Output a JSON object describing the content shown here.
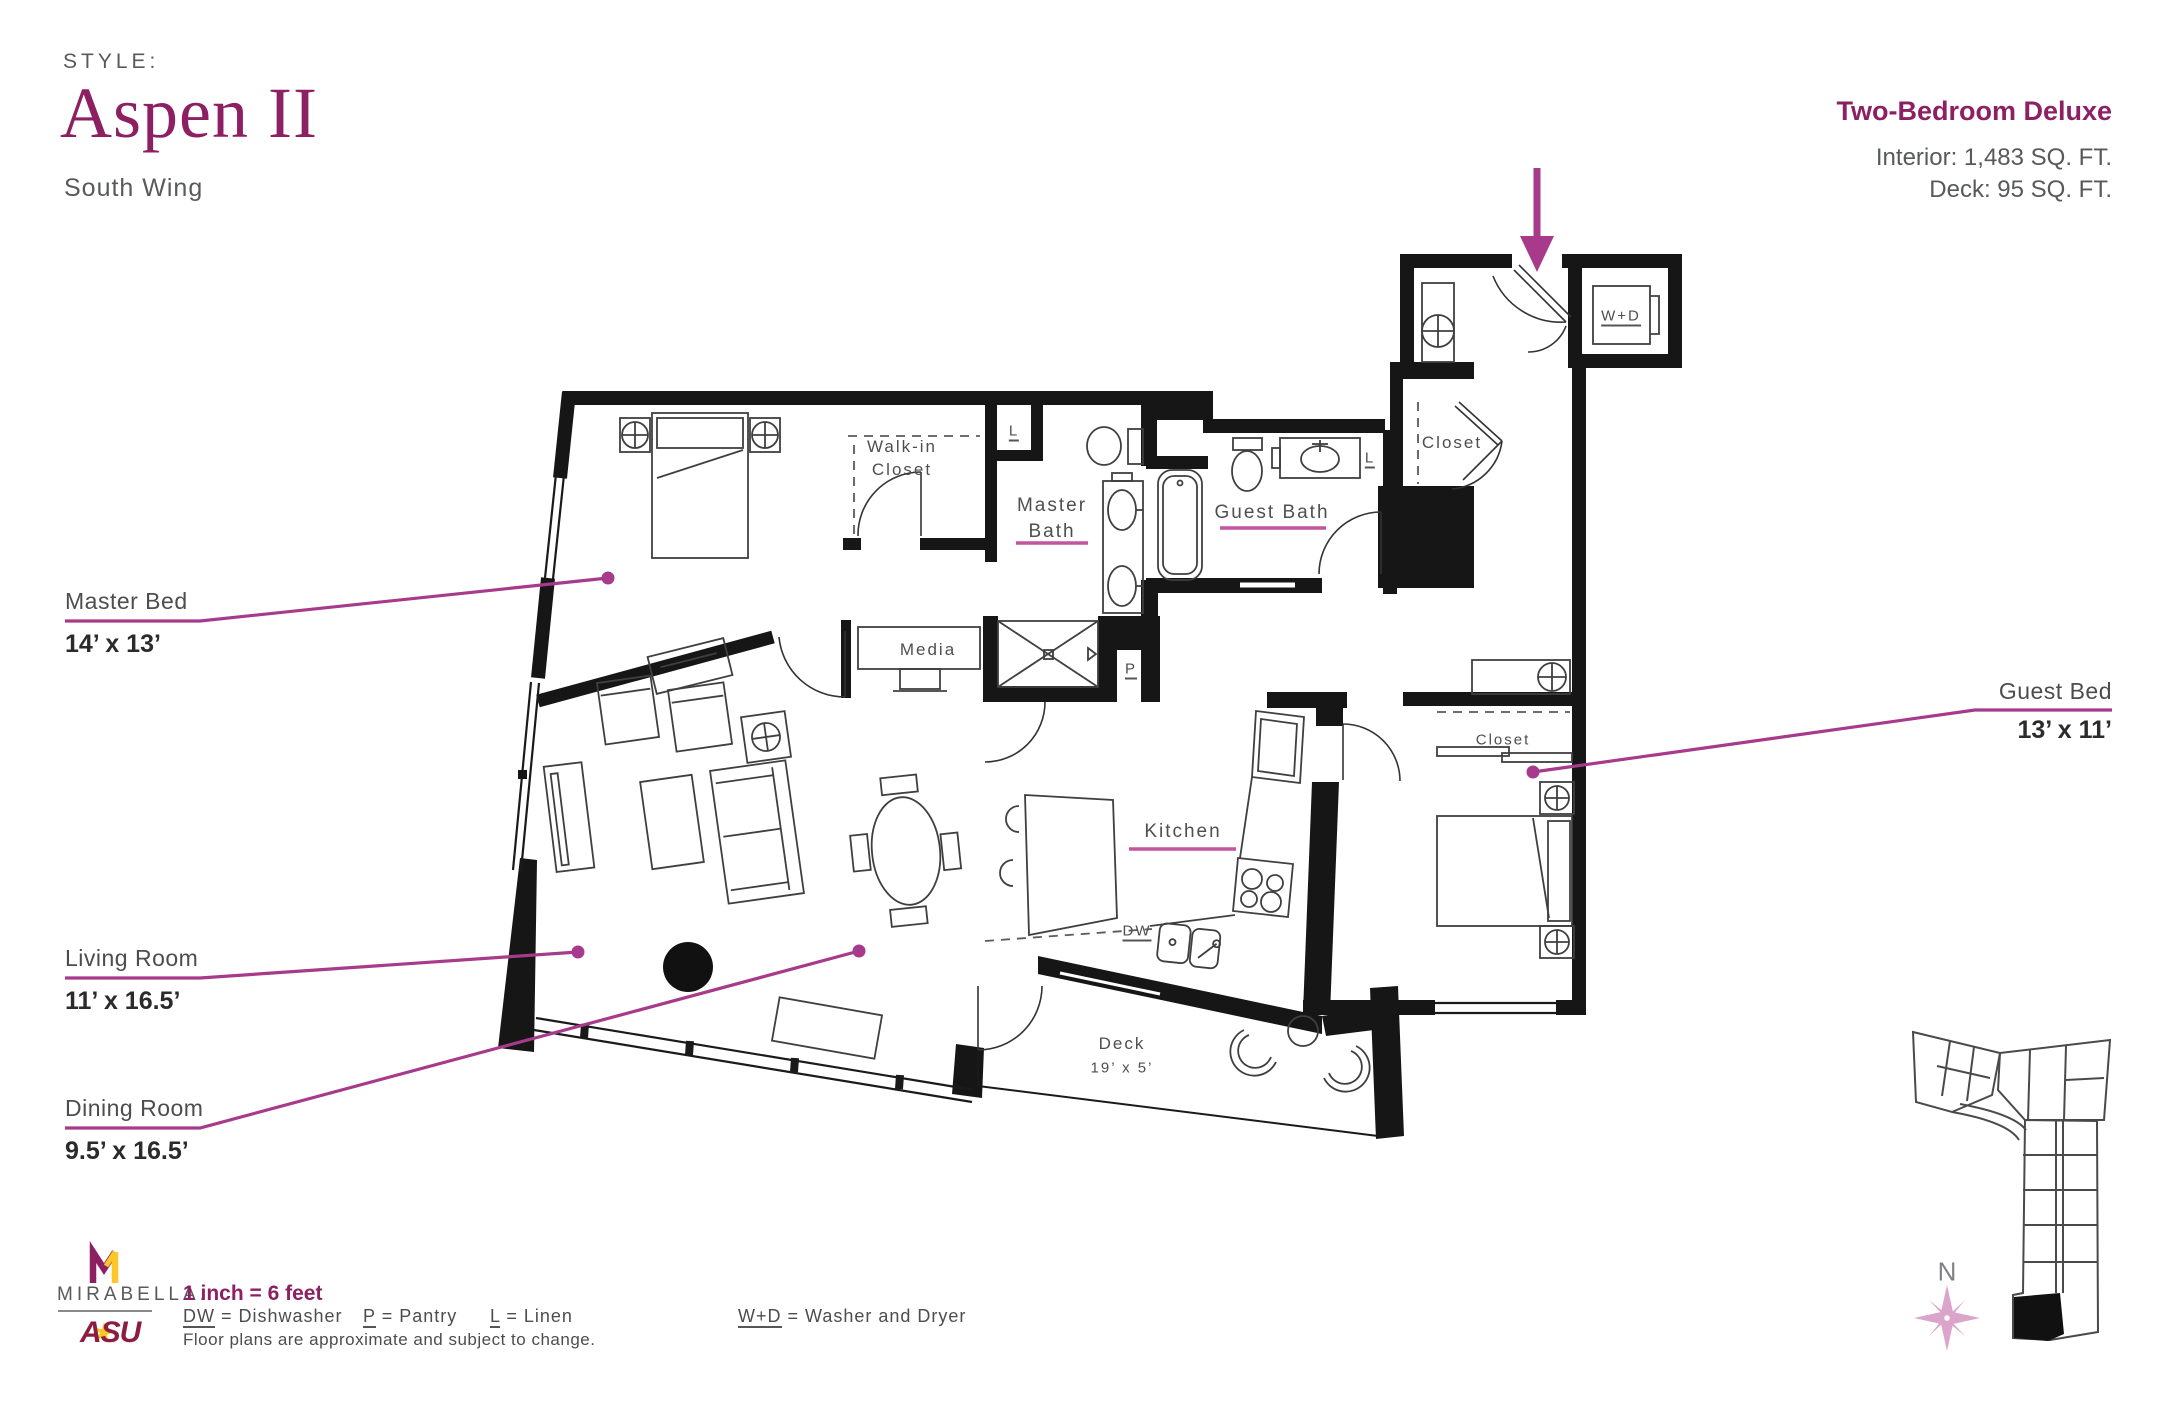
{
  "header": {
    "style_label": "STYLE:",
    "style_name": "Aspen II",
    "wing": "South Wing",
    "plan_type": "Two-Bedroom Deluxe",
    "interior_sqft": "Interior: 1,483 SQ. FT.",
    "deck_sqft": "Deck: 95 SQ. FT."
  },
  "rooms": {
    "master_bed": {
      "name": "Master Bed",
      "dims": "14’ x 13’"
    },
    "living_room": {
      "name": "Living Room",
      "dims": "11’ x 16.5’"
    },
    "dining_room": {
      "name": "Dining Room",
      "dims": "9.5’ x 16.5’"
    },
    "guest_bed": {
      "name": "Guest Bed",
      "dims": "13’ x 11’"
    },
    "master_bath": {
      "line1": "Master",
      "line2": "Bath"
    },
    "guest_bath": "Guest Bath",
    "walk_in_closet": {
      "line1": "Walk-in",
      "line2": "Closet"
    },
    "kitchen": "Kitchen",
    "media": "Media",
    "deck": {
      "name": "Deck",
      "dims": "19’ x 5’"
    },
    "closet_entry": "Closet",
    "closet_guest": "Closet",
    "washer_dryer": "W+D",
    "dishwasher": "DW",
    "pantry": "P",
    "linen": "L"
  },
  "legend": {
    "scale": "1 inch = 6 feet",
    "separator": " = ",
    "items": [
      {
        "key": "DW",
        "name": "Dishwasher"
      },
      {
        "key": "P",
        "name": "Pantry"
      },
      {
        "key": "L",
        "name": "Linen"
      },
      {
        "key": "W+D",
        "name": "Washer and Dryer"
      }
    ],
    "note": "Floor plans are approximate and subject to change."
  },
  "branding": {
    "mirabella": "MIRABELLA.",
    "asu": "ASU"
  },
  "compass": {
    "label": "N"
  },
  "colors": {
    "brand": "#8d2063",
    "accent": "#a83a8c",
    "underline": "#c4549f",
    "text_gray": "#58595b",
    "plan_text": "#4f4f4f",
    "asu_maroon": "#8c1d40",
    "asu_gold": "#ffc627",
    "compass_pink": "#dba5cb"
  }
}
